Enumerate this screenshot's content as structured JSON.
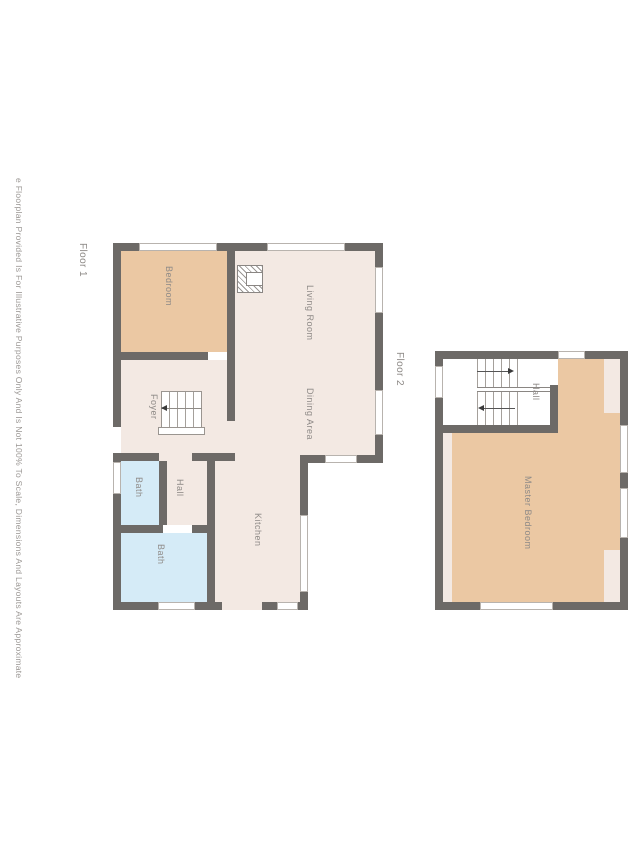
{
  "disclaimer": "e Floorplan Provided Is For Illustrative Purposes Only And Is Not 100% To Scale, Dimensions And Layouts Are Approximate",
  "floor1": {
    "label": "Floor 1",
    "rooms": [
      {
        "label": "Bedroom"
      },
      {
        "label": "Living Room"
      },
      {
        "label": "Dining Area"
      },
      {
        "label": "Foyer"
      },
      {
        "label": "Bath"
      },
      {
        "label": "Hall"
      },
      {
        "label": "Bath"
      },
      {
        "label": "Kitchen"
      }
    ]
  },
  "floor2": {
    "label": "Floor 2",
    "rooms": [
      {
        "label": "Hall"
      },
      {
        "label": "Master Bedroom"
      }
    ]
  },
  "colors": {
    "wall": "#6d6a67",
    "floor": "#f3e9e3",
    "bedroom_tan": "#ebc8a3",
    "bath_blue": "#d5ebf7",
    "window": "#ffffff",
    "label_text": "#8e8a87",
    "background": "#ffffff"
  }
}
